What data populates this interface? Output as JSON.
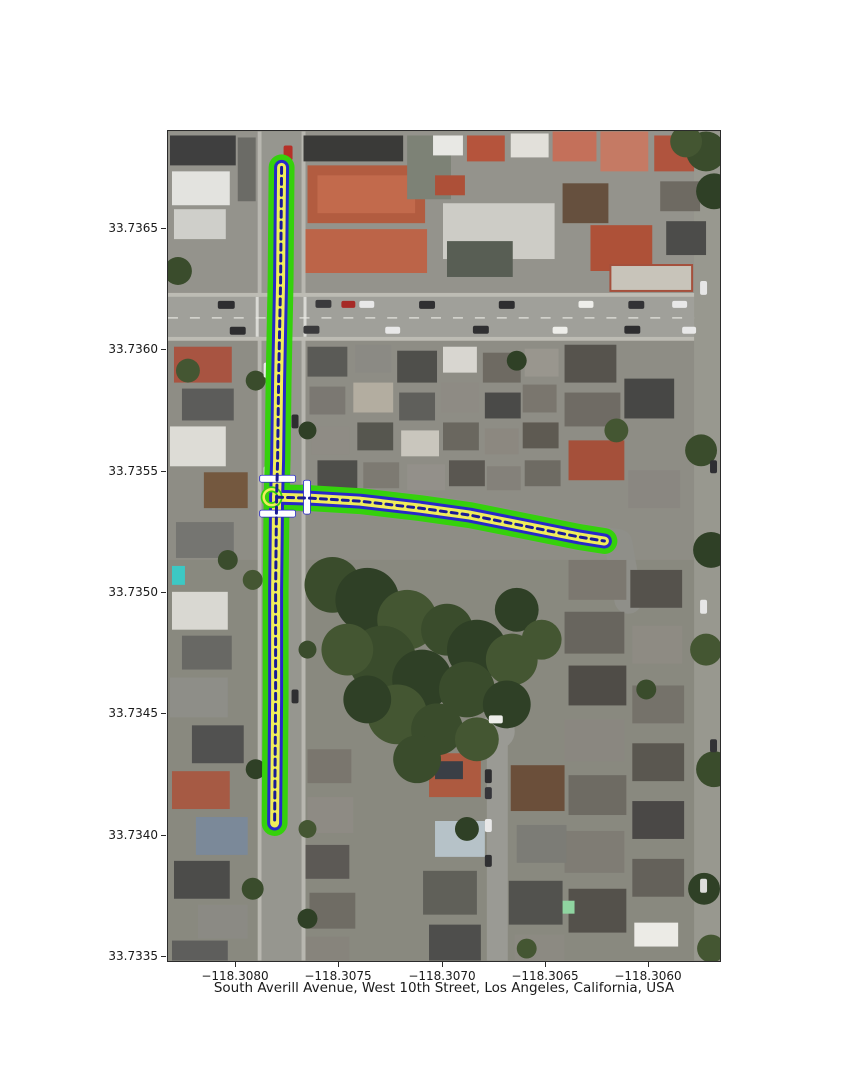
{
  "figure": {
    "title": "South Averill Avenue, West 10th Street, Los Angeles, California, USA",
    "x_axis": {
      "ticks": [
        "−118.3080",
        "−118.3075",
        "−118.3070",
        "−118.3065",
        "−118.3060"
      ]
    },
    "y_axis": {
      "ticks": [
        "33.7365",
        "33.7360",
        "33.7355",
        "33.7350",
        "33.7345",
        "33.7340",
        "33.7335"
      ]
    }
  },
  "chart_data": {
    "type": "map",
    "subtype": "satellite-basemap-with-street-route-overlay",
    "title": "South Averill Avenue, West 10th Street, Los Angeles, California, USA",
    "location": "Los Angeles, California, USA",
    "highlighted_streets": [
      "South Averill Avenue",
      "West 10th Street"
    ],
    "xlim_lon": [
      -118.30833,
      -118.30565
    ],
    "ylim_lat": [
      33.73347,
      33.73691
    ],
    "x_ticks_lon": [
      -118.308,
      -118.3075,
      -118.307,
      -118.3065,
      -118.306
    ],
    "y_ticks_lat": [
      33.7365,
      33.736,
      33.7355,
      33.735,
      33.7345,
      33.734,
      33.7335
    ],
    "grid": false,
    "legend": false,
    "routes": [
      {
        "name": "South Averill Avenue",
        "orientation": "north-south",
        "points_lonlat": [
          [
            -118.30778,
            33.73676
          ],
          [
            -118.30779,
            33.73626
          ],
          [
            -118.30781,
            33.73585
          ],
          [
            -118.30782,
            33.73554
          ],
          [
            -118.30782,
            33.73539
          ],
          [
            -118.30783,
            33.73501
          ],
          [
            -118.30783,
            33.73455
          ],
          [
            -118.30784,
            33.73404
          ]
        ]
      },
      {
        "name": "West 10th Street",
        "orientation": "east-west",
        "points_lonlat": [
          [
            -118.30782,
            33.73539
          ],
          [
            -118.30766,
            33.73539
          ],
          [
            -118.30742,
            33.73537
          ],
          [
            -118.30713,
            33.73535
          ],
          [
            -118.30689,
            33.73532
          ],
          [
            -118.30665,
            33.73528
          ],
          [
            -118.30648,
            33.73525
          ],
          [
            -118.30636,
            33.73523
          ],
          [
            -118.30621,
            33.73521
          ]
        ]
      }
    ],
    "intersection_lonlat": [
      -118.30782,
      33.73539
    ],
    "crossing_markers_lonlat": [
      [
        -118.3078,
        33.73546
      ],
      [
        -118.3078,
        33.73532
      ],
      [
        -118.30765,
        33.73539
      ]
    ],
    "overlay_style": {
      "outer_casing_color": "#35d10c",
      "mid_casing_color": "#2828c8",
      "inner_fill_color": "#f0ee5a",
      "centerline_color": "#1a1a96",
      "centerline_style": "dashed",
      "crossing_marker_color": "#ffffff"
    }
  }
}
